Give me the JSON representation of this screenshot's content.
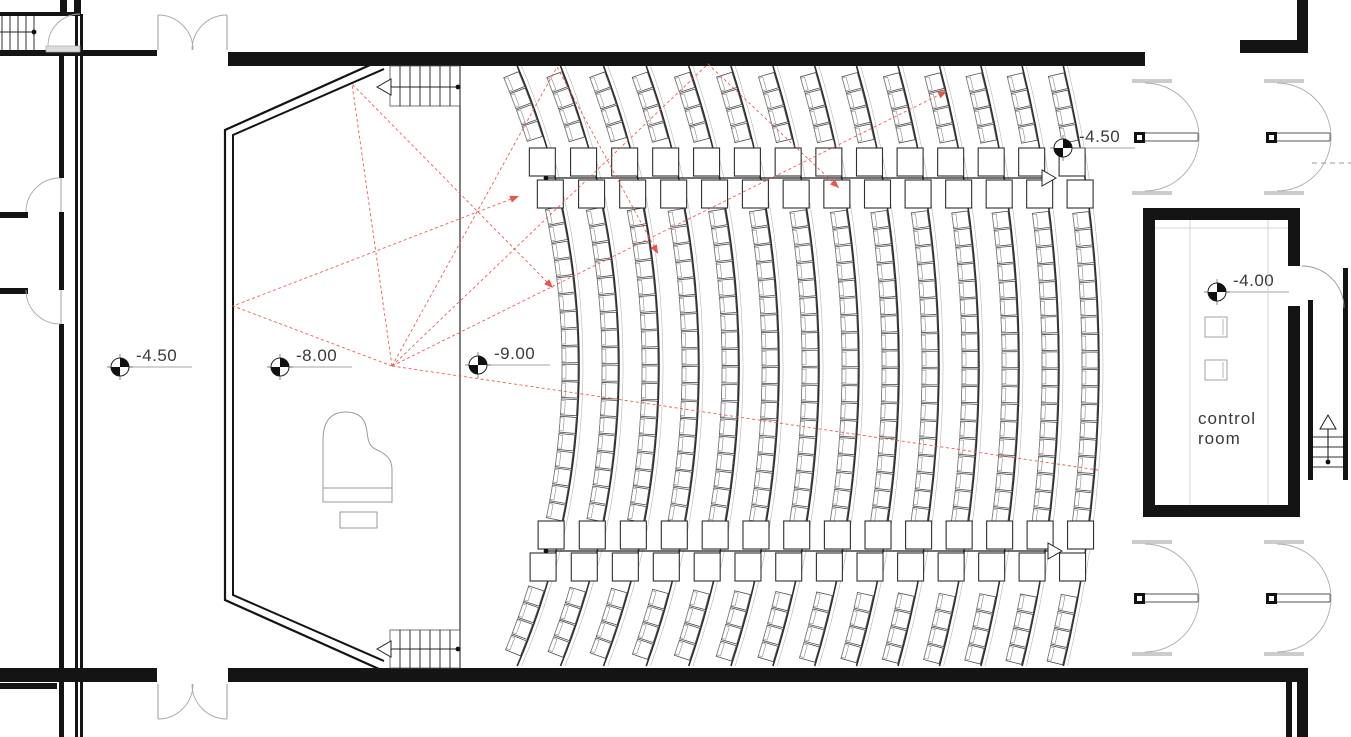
{
  "title": "auditorium-floor-plan",
  "colors": {
    "wall": "#141414",
    "thin_line": "#3a3a3a",
    "light_line": "#aaaaaa",
    "seat_stroke": "#4d4d4d",
    "seat_inner": "#8c8c8c",
    "row_arc": "#2f2f2f",
    "ray_red": "#e8554d",
    "text": "#3a3a3a"
  },
  "level_markers": [
    {
      "value": "-4.50",
      "x": 120,
      "y": 367
    },
    {
      "value": "-8.00",
      "x": 280,
      "y": 367
    },
    {
      "value": "-9.00",
      "x": 478,
      "y": 365
    },
    {
      "value": "-4.50",
      "x": 1063,
      "y": 148
    },
    {
      "value": "-4.00",
      "x": 1217,
      "y": 292
    }
  ],
  "control_room": {
    "line1": "control",
    "line2": "room",
    "x": 1198,
    "y": 424
  },
  "seating": {
    "center": [
      -180,
      366
    ],
    "row_count": 14,
    "first_radius": 740,
    "row_step": 40,
    "seat_spacing": 17.5,
    "seat_size": 16,
    "y_extent": [
      74,
      658
    ],
    "aisle_bands_y": [
      [
        146,
        214
      ],
      [
        518,
        588
      ]
    ],
    "aisle_lines": [
      {
        "y": 178,
        "x1": 546,
        "x2": 1042,
        "dot_at_start": true,
        "arrow_at_end": true
      },
      {
        "y": 551,
        "x1": 546,
        "x2": 1048,
        "dot_at_start": true,
        "arrow_at_end": true
      }
    ]
  },
  "acoustic_rays": {
    "source": [
      392,
      366
    ],
    "paths": [
      {
        "points": [
          [
            392,
            366
          ],
          [
            352,
            84
          ],
          [
            553,
            288
          ]
        ],
        "arrow": true
      },
      {
        "points": [
          [
            392,
            366
          ],
          [
            233,
            306
          ],
          [
            519,
            196
          ]
        ],
        "arrow": true
      },
      {
        "points": [
          [
            392,
            366
          ],
          [
            557,
            67
          ],
          [
            658,
            254
          ]
        ],
        "arrow": true
      },
      {
        "points": [
          [
            392,
            366
          ],
          [
            708,
            64
          ],
          [
            839,
            188
          ]
        ],
        "arrow": true
      },
      {
        "points": [
          [
            392,
            366
          ],
          [
            947,
            91
          ]
        ],
        "arrow": true
      },
      {
        "points": [
          [
            392,
            366
          ],
          [
            1098,
            470
          ]
        ],
        "arrow": false
      }
    ]
  },
  "stairs": {
    "stage_top": {
      "x": 390,
      "y": 66,
      "w": 70,
      "h": 40,
      "arrow_dir": "left"
    },
    "stage_bottom": {
      "x": 390,
      "y": 630,
      "w": 70,
      "h": 38,
      "arrow_dir": "left"
    },
    "mini_top_left": {
      "x": 0,
      "y": 16,
      "w": 36,
      "h": 34
    },
    "right_stairwell": {
      "x": 1313,
      "y": 437,
      "w": 30,
      "arrow_dir": "up"
    }
  }
}
